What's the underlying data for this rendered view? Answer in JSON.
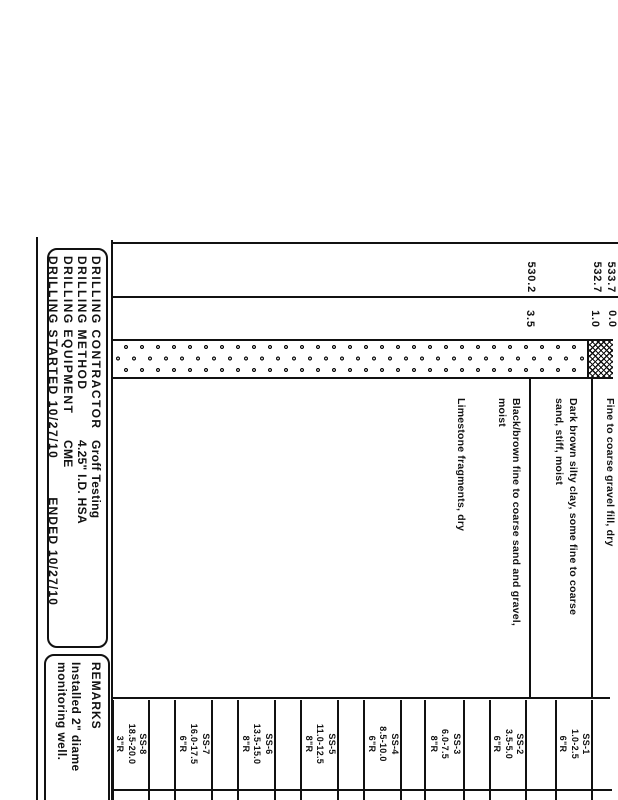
{
  "colors": {
    "ink": "#111111",
    "paper": "#ffffff"
  },
  "strata": {
    "elevations": [
      "533.7",
      "532.7",
      "530.2"
    ],
    "depths": [
      "0.0",
      "1.0",
      "3.5"
    ],
    "descriptions": [
      "Fine to coarse gravel fill, dry",
      "Dark brown silty clay, some fine to coarse",
      "sand, stiff, moist",
      "Black/brown fine to coarse sand and gravel,",
      "moist",
      "Limestone fragments, dry"
    ],
    "symbols": [
      "gravel-circles-pattern",
      "crosshatch-fill-pattern"
    ]
  },
  "samples": [
    {
      "id": "SS-1",
      "interval": "1.0-2.5",
      "recovery": "6\"R"
    },
    {
      "id": "SS-2",
      "interval": "3.5-5.0",
      "recovery": "6\"R"
    },
    {
      "id": "SS-3",
      "interval": "6.0-7.5",
      "recovery": "8\"R"
    },
    {
      "id": "SS-4",
      "interval": "8.5-10.0",
      "recovery": "6\"R"
    },
    {
      "id": "SS-5",
      "interval": "11.0-12.5",
      "recovery": "8\"R"
    },
    {
      "id": "SS-6",
      "interval": "13.5-15.0",
      "recovery": "8\"R"
    },
    {
      "id": "SS-7",
      "interval": "16.0-17.5",
      "recovery": "6\"R"
    },
    {
      "id": "SS-8",
      "interval": "18.5-20.0",
      "recovery": "3\"R"
    }
  ],
  "drilling_info": {
    "rows": [
      {
        "label": "DRILLING CONTRACTOR",
        "value": "Groff Testing"
      },
      {
        "label": "DRILLING METHOD",
        "value": "4.25\" I.D. HSA"
      },
      {
        "label": "DRILLING EQUIPMENT",
        "value": "CME"
      },
      {
        "label": "DRILLING STARTED 10/27/10",
        "value": "ENDED 10/27/10"
      }
    ]
  },
  "remarks": {
    "title": "REMARKS",
    "lines": [
      "Installed 2\" diame",
      "monitoring well."
    ]
  }
}
